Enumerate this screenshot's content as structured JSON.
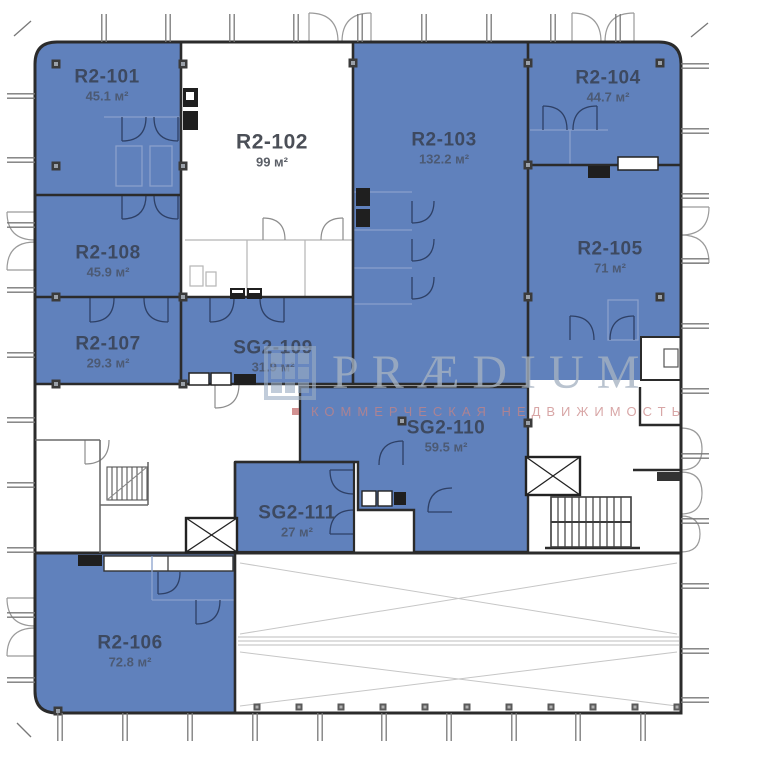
{
  "watermark": {
    "brand": "PRÆDIUM",
    "tagline": "КОММЕРЧЕСКАЯ НЕДВИЖИМОСТЬ"
  },
  "rooms": {
    "r2_101": {
      "name": "R2-101",
      "area": "45.1 м²"
    },
    "r2_102": {
      "name": "R2-102",
      "area": "99 м²"
    },
    "r2_103": {
      "name": "R2-103",
      "area": "132.2 м²"
    },
    "r2_104": {
      "name": "R2-104",
      "area": "44.7 м²"
    },
    "r2_105": {
      "name": "R2-105",
      "area": "71 м²"
    },
    "r2_106": {
      "name": "R2-106",
      "area": "72.8 м²"
    },
    "r2_107": {
      "name": "R2-107",
      "area": "29.3 м²"
    },
    "r2_108": {
      "name": "R2-108",
      "area": "45.9 м²"
    },
    "sg2_109": {
      "name": "SG2-109",
      "area": "31.9 м²"
    },
    "sg2_110": {
      "name": "SG2-110",
      "area": "59.5 м²"
    },
    "sg2_111": {
      "name": "SG2-111",
      "area": "27 м²"
    }
  },
  "colors": {
    "room_fill": "#6081bc",
    "wall": "#2b2b2b",
    "label": "#3d4960",
    "watermark_text": "#a5b2c2",
    "watermark_tagline": "#c98383"
  }
}
